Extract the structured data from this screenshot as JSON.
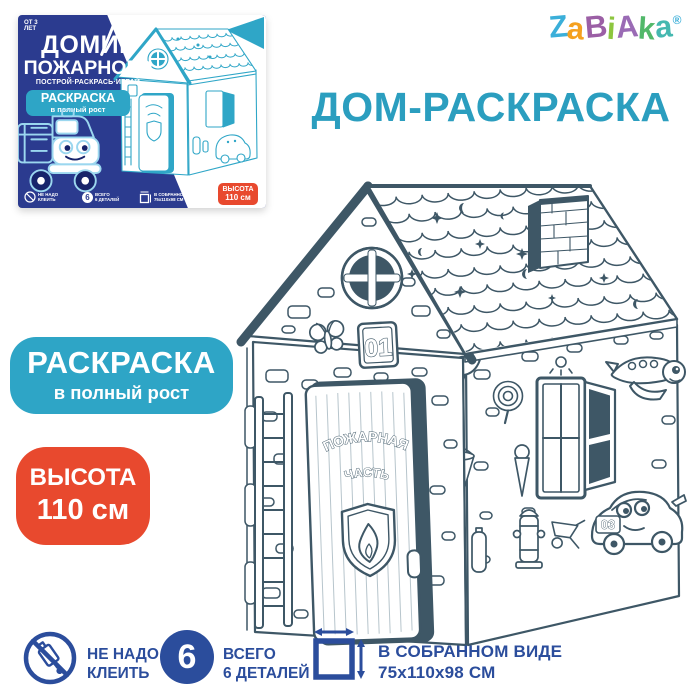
{
  "brand": {
    "name": "ZABIAKA",
    "letters": [
      {
        "ch": "Z",
        "color": "#3BAFD9"
      },
      {
        "ch": "a",
        "color": "#F5A11F"
      },
      {
        "ch": "B",
        "color": "#9B5FA5"
      },
      {
        "ch": "i",
        "color": "#8DC63F"
      },
      {
        "ch": "A",
        "color": "#9A6BB5"
      },
      {
        "ch": "k",
        "color": "#52B86A"
      },
      {
        "ch": "a",
        "color": "#45B8B0"
      }
    ],
    "registered_mark": "®"
  },
  "page_title": "ДОМ-РАСКРАСКА",
  "coloring_badge": {
    "line1": "РАСКРАСКА",
    "line2": "в полный рост"
  },
  "height_badge": {
    "line1": "ВЫСОТА",
    "line2": "110 см"
  },
  "box": {
    "age_badge": "ОТ 3 ЛЕТ",
    "title_line1": "ДОМИК",
    "title_line2": "ПОЖАРНОГО",
    "subtitle": "ПОСТРОЙ·РАСКРАСЬ·ИГРАЙ",
    "coloring_badge_line1": "РАСКРАСКА",
    "coloring_badge_line2": "в полный рост",
    "height_badge_line1": "ВЫСОТА",
    "height_badge_line2": "110 см",
    "parts_count": "6",
    "footer": [
      {
        "line1": "НЕ НАДО",
        "line2": "КЛЕИТЬ"
      },
      {
        "line1": "ВСЕГО",
        "line2": "6 ДЕТАЛЕЙ"
      },
      {
        "line1": "В СОБРАННОМ ВИДЕ",
        "line2": "75х110х98 СМ"
      }
    ]
  },
  "house": {
    "door_sign_line1": "ПОЖАРНАЯ",
    "door_sign_line2": "ЧАСТЬ",
    "door_plaque": "01",
    "car_number": "03"
  },
  "features": [
    {
      "icon": "no-glue-icon",
      "line1": "НЕ НАДО",
      "line2": "КЛЕИТЬ"
    },
    {
      "icon": "six-parts-badge",
      "value": "6",
      "line1": "ВСЕГО",
      "line2": "6 ДЕТАЛЕЙ"
    },
    {
      "icon": "assembled-dimensions-icon",
      "line1": "В СОБРАННОМ ВИДЕ",
      "line2": "75x110x98 СМ"
    }
  ],
  "colors": {
    "accent_teal": "#2EA5C6",
    "title_teal": "#2B9EBF",
    "badge_red": "#E8492E",
    "box_blue": "#2B3B8F",
    "feature_blue": "#2B4D9C",
    "lineart_ink": "#3E5766"
  }
}
